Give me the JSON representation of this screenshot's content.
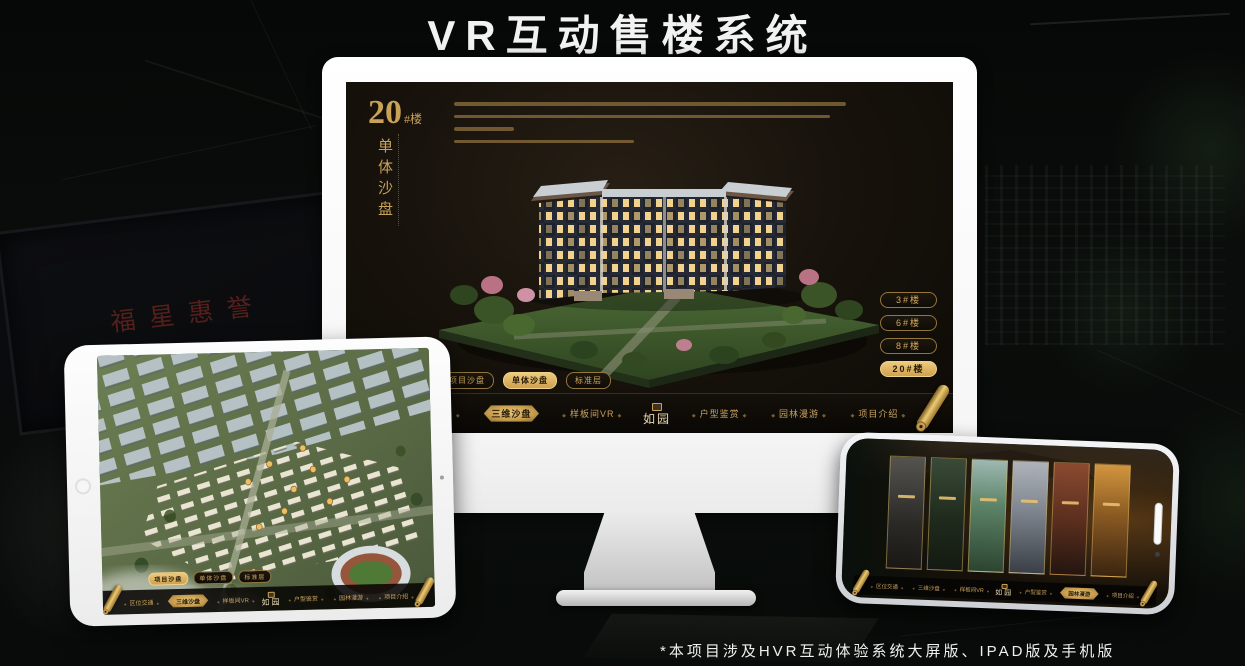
{
  "page": {
    "title": "VR互动售楼系统",
    "footnote": "*本项目涉及HVR互动体验系统大屏版、IPAD版及手机版"
  },
  "brand": {
    "logo_text": "如园"
  },
  "background": {
    "plaque_text": "福星惠誉"
  },
  "colors": {
    "gold": "#d2a75c",
    "gold_bright": "#ecc377",
    "screen_bg": "#17120c",
    "page_bg": "#080b09"
  },
  "icons": {
    "scroll": "rolled-gold-scroll",
    "seal": "square-gold-seal",
    "nav_ornament": "◆"
  },
  "desktop": {
    "title_number": "20",
    "title_suffix": "#楼",
    "title_vertical": "单体沙盘",
    "tabs": [
      {
        "label": "项目沙盘"
      },
      {
        "label": "单体沙盘"
      },
      {
        "label": "标准层"
      }
    ],
    "active_tab": "单体沙盘",
    "floor_buttons": [
      {
        "label": "3#楼"
      },
      {
        "label": "6#楼"
      },
      {
        "label": "8#楼"
      },
      {
        "label": "20#楼"
      }
    ],
    "active_floor": "20#楼",
    "nav": [
      {
        "label": "区位交通"
      },
      {
        "label": "三维沙盘"
      },
      {
        "label": "样板间VR"
      },
      {
        "label": "户型鉴赏"
      },
      {
        "label": "园林漫游"
      },
      {
        "label": "项目介绍"
      }
    ],
    "active_nav": "三维沙盘"
  },
  "tablet": {
    "tabs": [
      {
        "label": "项目沙盘"
      },
      {
        "label": "单体沙盘"
      },
      {
        "label": "标准层"
      }
    ],
    "active_tab": "项目沙盘",
    "nav": [
      {
        "label": "区位交通"
      },
      {
        "label": "三维沙盘"
      },
      {
        "label": "样板间VR"
      },
      {
        "label": "户型鉴赏"
      },
      {
        "label": "园林漫游"
      },
      {
        "label": "项目介绍"
      }
    ],
    "active_nav": "三维沙盘"
  },
  "phone": {
    "nav": [
      {
        "label": "区位交通"
      },
      {
        "label": "三维沙盘"
      },
      {
        "label": "样板间VR"
      },
      {
        "label": "户型鉴赏"
      },
      {
        "label": "园林漫游"
      },
      {
        "label": "项目介绍"
      }
    ],
    "active_nav": "园林漫游",
    "gallery_panel_count": 6
  }
}
